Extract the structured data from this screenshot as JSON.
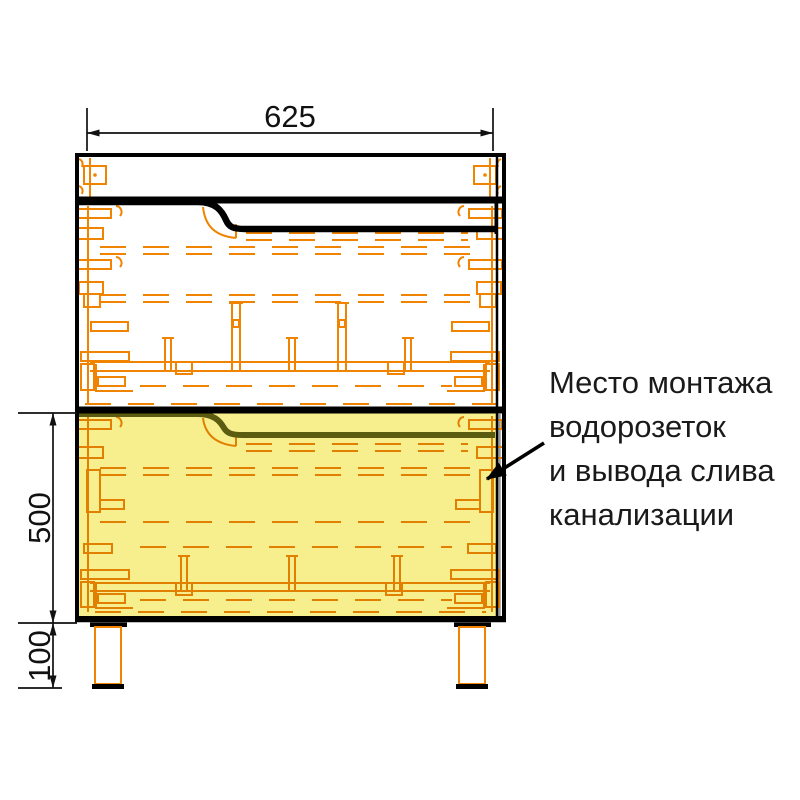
{
  "drawing": {
    "title": "cabinet-front-installation-diagram",
    "dimensions": {
      "width_mm": "625",
      "plumbing_zone_height_mm": "500",
      "legs_height_mm": "100"
    },
    "annotation": {
      "lines": [
        "Место монтажа",
        "водорозеток",
        "и вывода слива",
        "канализации"
      ]
    },
    "colors": {
      "hardware_orange": "#F08300",
      "highlight_yellow": "#F7EF8D",
      "outline_black": "#000000"
    }
  }
}
